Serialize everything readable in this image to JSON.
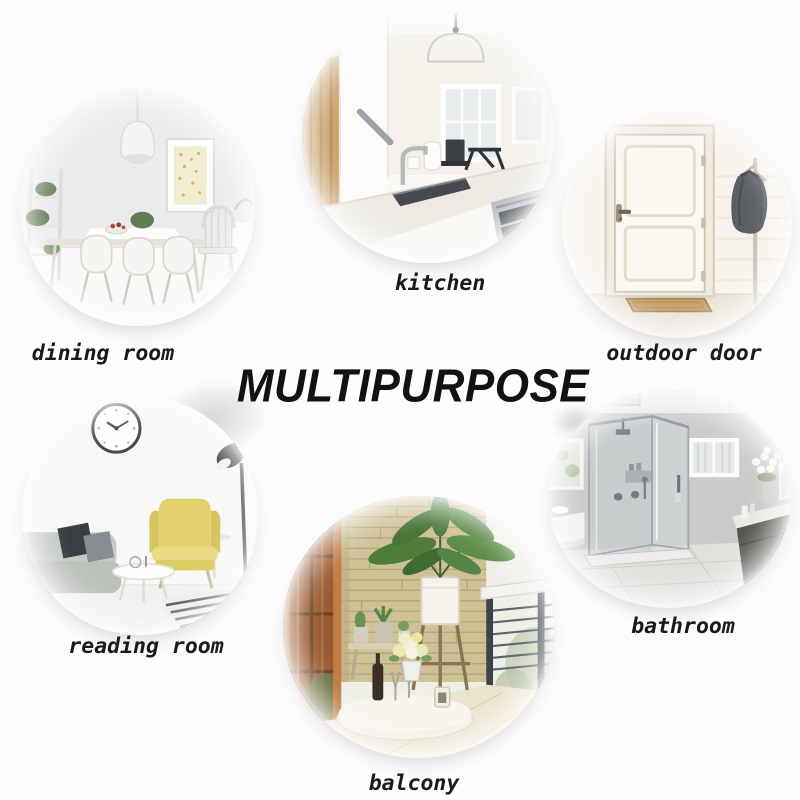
{
  "title": {
    "text": "MULTIPURPOSE",
    "color": "#121212"
  },
  "rooms": [
    {
      "label": "dining room"
    },
    {
      "label": "kitchen"
    },
    {
      "label": "outdoor door"
    },
    {
      "label": "reading room"
    },
    {
      "label": "bathroom"
    },
    {
      "label": "balcony"
    }
  ],
  "colors": {
    "background": "#fdfdfd",
    "label_text": "#1a1a1a",
    "title_text": "#121212",
    "accent_yellow_chair": "#e2d16c",
    "accent_wood": "#c89e66",
    "accent_brick": "#cfc196",
    "accent_plant_green": "#4e7c3b"
  }
}
